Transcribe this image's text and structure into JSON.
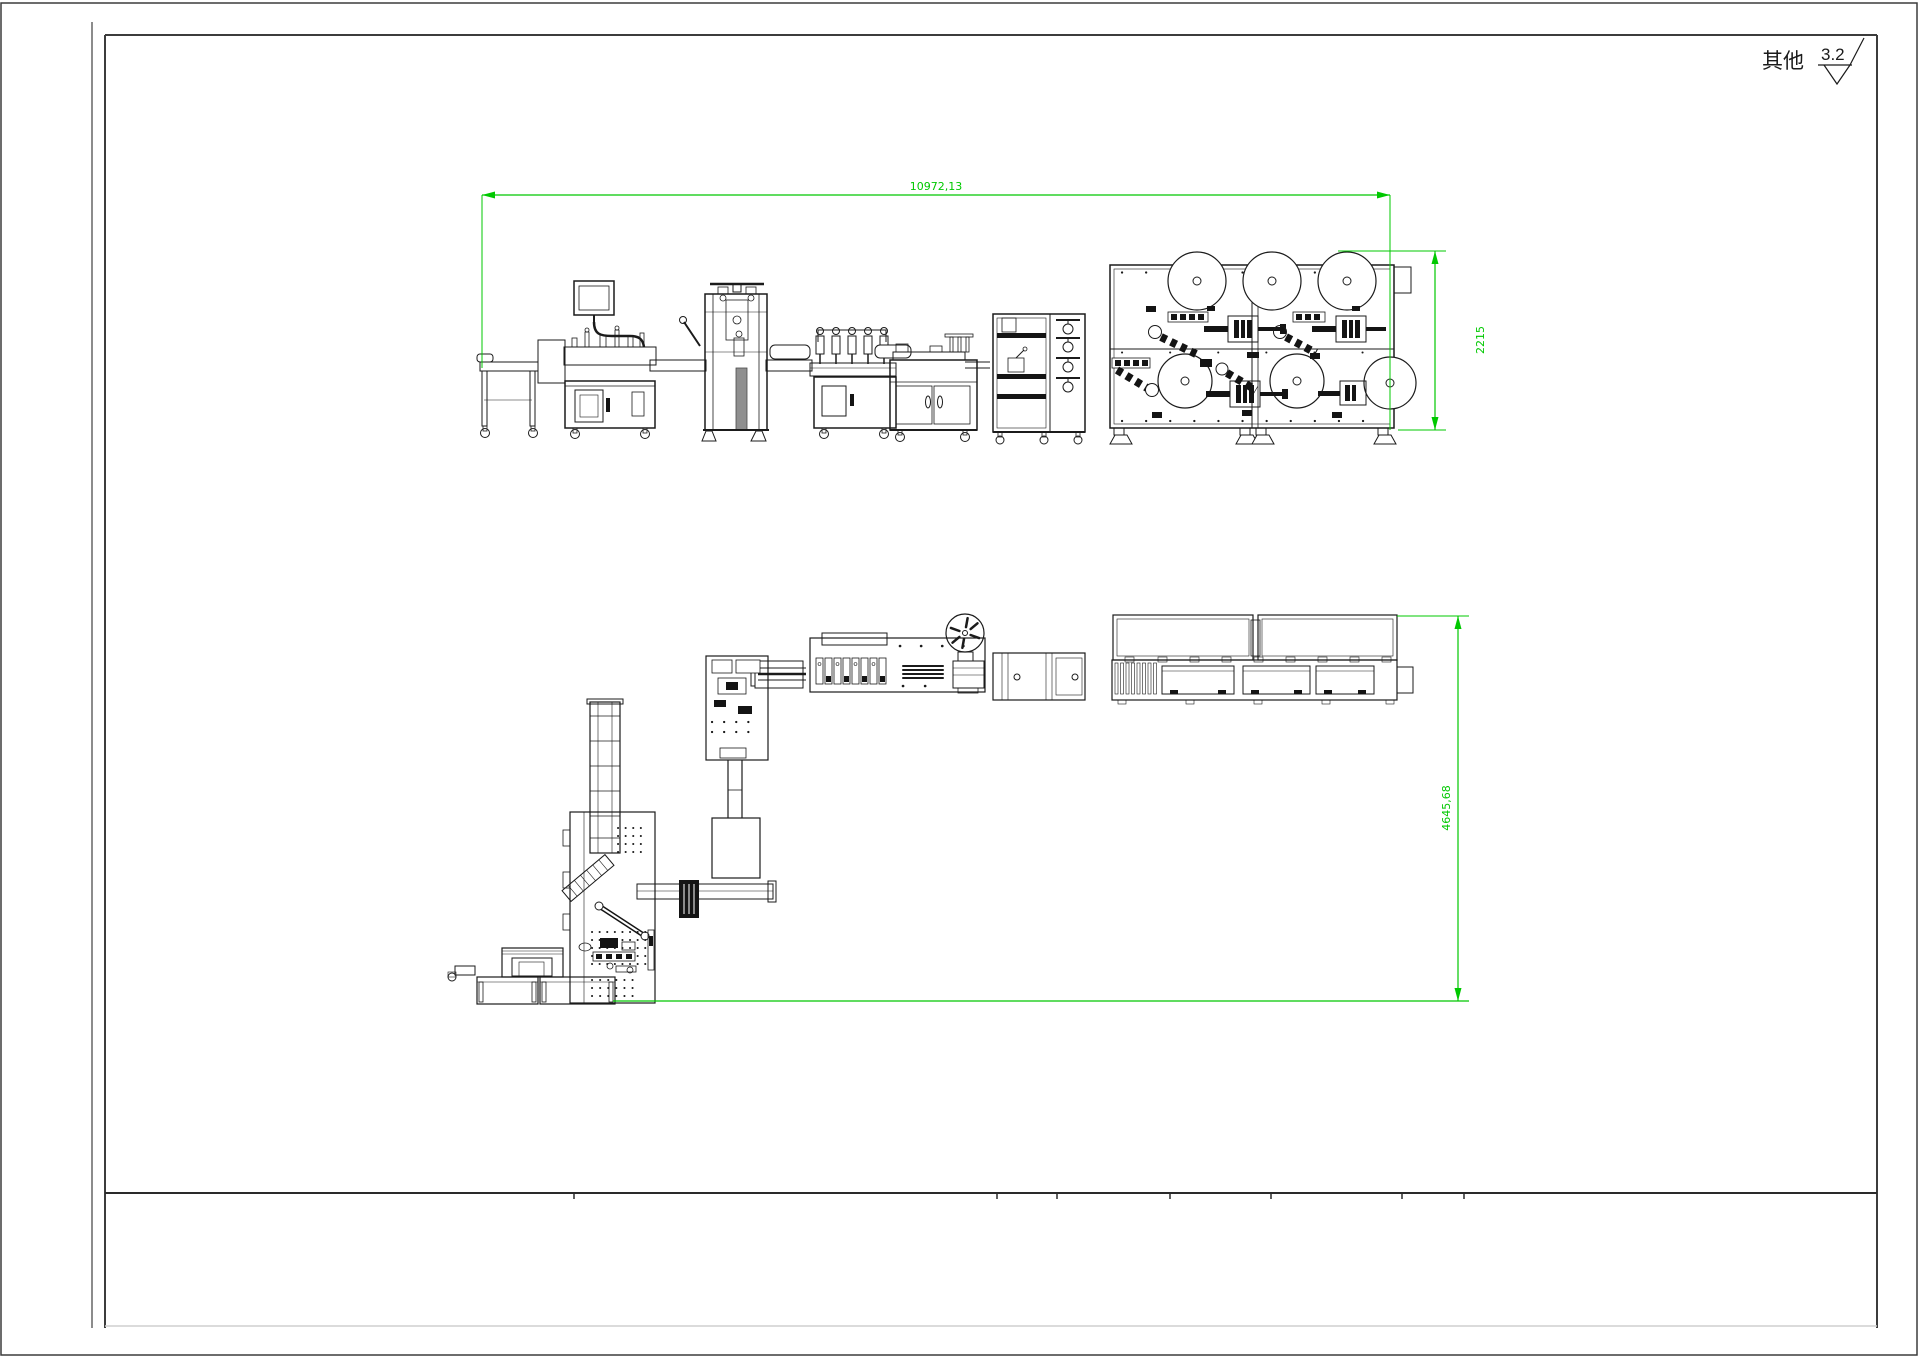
{
  "sheet": {
    "background": "#ffffff",
    "line_color": "#1b1b1b",
    "frame_color": "#3c3c3c",
    "dimension_color": "#00c800",
    "surface_note": {
      "label": "其他",
      "roughness": "3.2",
      "icon": "surface-roughness-icon"
    }
  },
  "views": {
    "front": {
      "description": "production line front elevation",
      "dimensions": {
        "width": "10972,13",
        "height": "2215"
      }
    },
    "plan": {
      "description": "production line plan layout",
      "dimensions": {
        "height": "4645,68"
      }
    }
  }
}
